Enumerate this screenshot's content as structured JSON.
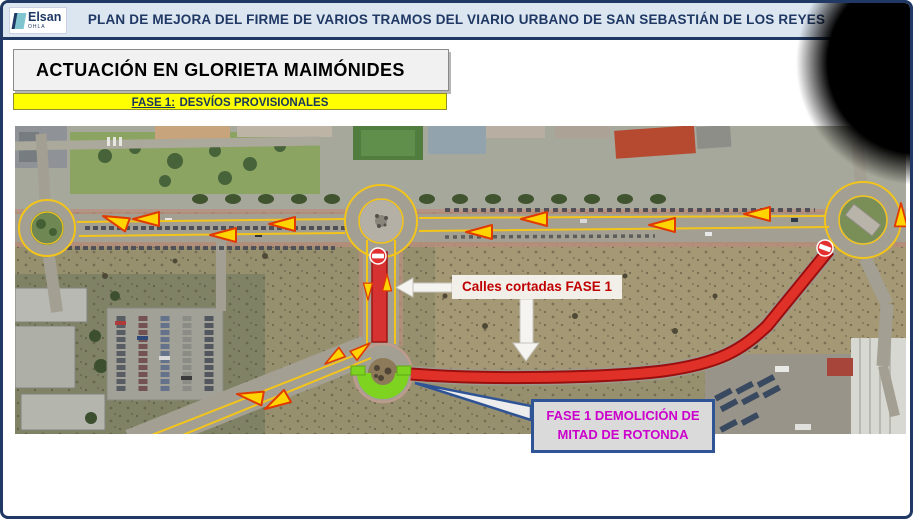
{
  "header": {
    "logo": {
      "brand": "Elsan",
      "group": "OHLA"
    },
    "title": "PLAN DE MEJORA DEL FIRME DE VARIOS TRAMOS DEL VIARIO URBANO DE SAN SEBASTIÁN DE LOS REYES",
    "bg_color": "#DCE6F1",
    "accent_color": "#1F3864"
  },
  "section": {
    "title": "ACTUACIÓN EN GLORIETA MAIMÓNIDES",
    "phase": {
      "label": "FASE 1:",
      "text": "DESVÍOS PROVISIONALES",
      "highlight_color": "#FFFF00"
    }
  },
  "map": {
    "labels": {
      "closed_streets": "Calles cortadas FASE 1",
      "demolition_line1": "FASE 1 DEMOLICIÓN DE",
      "demolition_line2": "MITAD DE ROTONDA"
    },
    "colors": {
      "closed_road_overlay": "#E02020",
      "detour_arrow": "#FFD400",
      "demolition_zone": "#7ED321",
      "closed_streets_text": "#C00000",
      "demolition_text": "#CC00CC",
      "callout_border": "#2F5496",
      "lane_guide_line": "#F3C51B"
    },
    "icons": {
      "no_entry": "no-entry-icon",
      "detour_arrow": "detour-arrow-icon"
    }
  }
}
